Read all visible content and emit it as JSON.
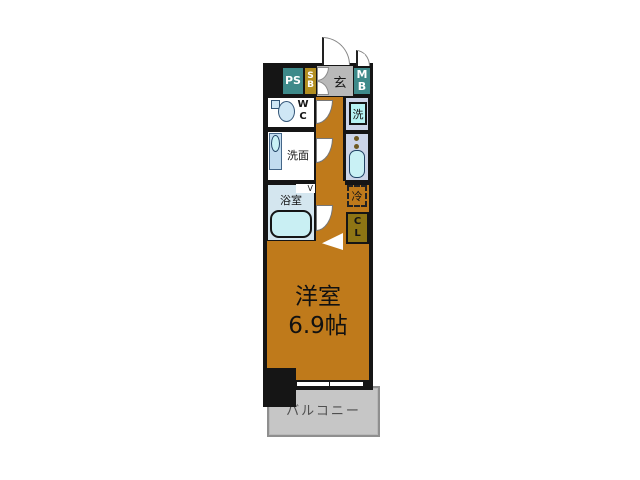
{
  "plan_title": "1K apartment floor plan",
  "colors": {
    "wall": "#151515",
    "floor_orange": "#bf7a1b",
    "utility_teal": "#3e8a8a",
    "shoebox_gold": "#b28e20",
    "closet_olive": "#8e7514",
    "entrance_gray": "#b9b9b9",
    "balcony_gray": "#c6c6c6",
    "kitchen_lavender": "#ccd5e8",
    "fixture_cyan": "#b7f3f3",
    "bathroom_blue": "#d4e6ef"
  },
  "rooms": {
    "main_room": {
      "name": "洋室",
      "size": "6.9帖"
    },
    "balcony": {
      "label": "バルコニー"
    },
    "entrance": {
      "label": "玄"
    },
    "pipe_space": {
      "label": "PS"
    },
    "shoe_box": {
      "label": "SB"
    },
    "meter_box": {
      "label": "MB"
    },
    "toilet": {
      "label": "WC"
    },
    "washroom": {
      "label": "洗面"
    },
    "bathroom": {
      "label": "浴室"
    },
    "washer": {
      "label": "洗"
    },
    "refrigerator": {
      "label": "冷"
    },
    "closet": {
      "label": "CL"
    }
  },
  "marks": {
    "bath_door": "V"
  }
}
